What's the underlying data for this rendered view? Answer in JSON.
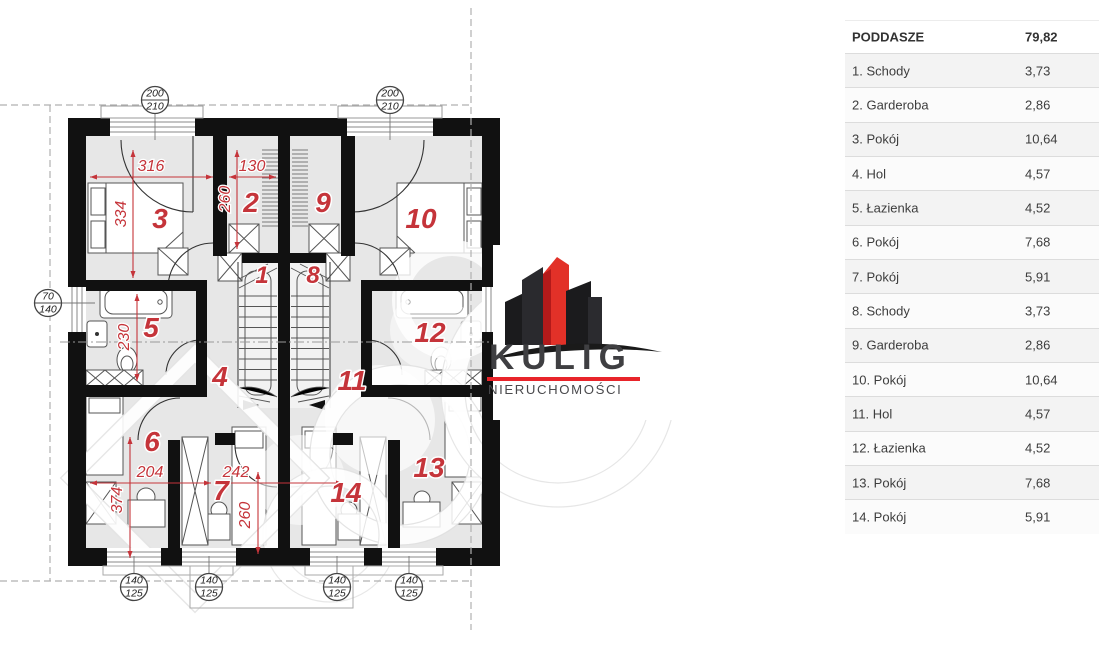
{
  "logo": {
    "brand": "KULIG",
    "subtitle": "NIERUCHOMOŚCI"
  },
  "summary_table": {
    "header": {
      "label": "PODDASZE",
      "value": "79,82"
    },
    "rows": [
      {
        "label": "1. Schody",
        "value": "3,73"
      },
      {
        "label": "2. Garderoba",
        "value": "2,86"
      },
      {
        "label": "3. Pokój",
        "value": "10,64"
      },
      {
        "label": "4. Hol",
        "value": "4,57"
      },
      {
        "label": "5. Łazienka",
        "value": "4,52"
      },
      {
        "label": "6. Pokój",
        "value": "7,68"
      },
      {
        "label": "7. Pokój",
        "value": "5,91"
      },
      {
        "label": "8. Schody",
        "value": "3,73"
      },
      {
        "label": "9. Garderoba",
        "value": "2,86"
      },
      {
        "label": "10. Pokój",
        "value": "10,64"
      },
      {
        "label": "11. Hol",
        "value": "4,57"
      },
      {
        "label": "12. Łazienka",
        "value": "4,52"
      },
      {
        "label": "13. Pokój",
        "value": "7,68"
      },
      {
        "label": "14. Pokój",
        "value": "5,91"
      }
    ]
  },
  "floor_plan": {
    "title": "Poddasze (attic) duplex floor plan",
    "rooms": [
      {
        "num": "1"
      },
      {
        "num": "2"
      },
      {
        "num": "3"
      },
      {
        "num": "4"
      },
      {
        "num": "5"
      },
      {
        "num": "6"
      },
      {
        "num": "7"
      },
      {
        "num": "8"
      },
      {
        "num": "9"
      },
      {
        "num": "10"
      },
      {
        "num": "11"
      },
      {
        "num": "12"
      },
      {
        "num": "13"
      },
      {
        "num": "14"
      }
    ],
    "dimensions": [
      {
        "label": "316"
      },
      {
        "label": "334"
      },
      {
        "label": "130"
      },
      {
        "label": "260"
      },
      {
        "label": "230"
      },
      {
        "label": "204"
      },
      {
        "label": "242"
      },
      {
        "label": "374"
      },
      {
        "label": "260"
      }
    ],
    "markers": [
      {
        "top": "200",
        "bottom": "210"
      },
      {
        "top": "200",
        "bottom": "210"
      },
      {
        "top": "70",
        "bottom": "140"
      },
      {
        "top": "140",
        "bottom": "125"
      },
      {
        "top": "140",
        "bottom": "125"
      },
      {
        "top": "140",
        "bottom": "125"
      },
      {
        "top": "140",
        "bottom": "125"
      }
    ],
    "colors": {
      "dimension_red": "#c5343a",
      "wall_black": "#111111",
      "floor_gray": "#e7e7e7",
      "accent_red": "#e8242a"
    }
  }
}
